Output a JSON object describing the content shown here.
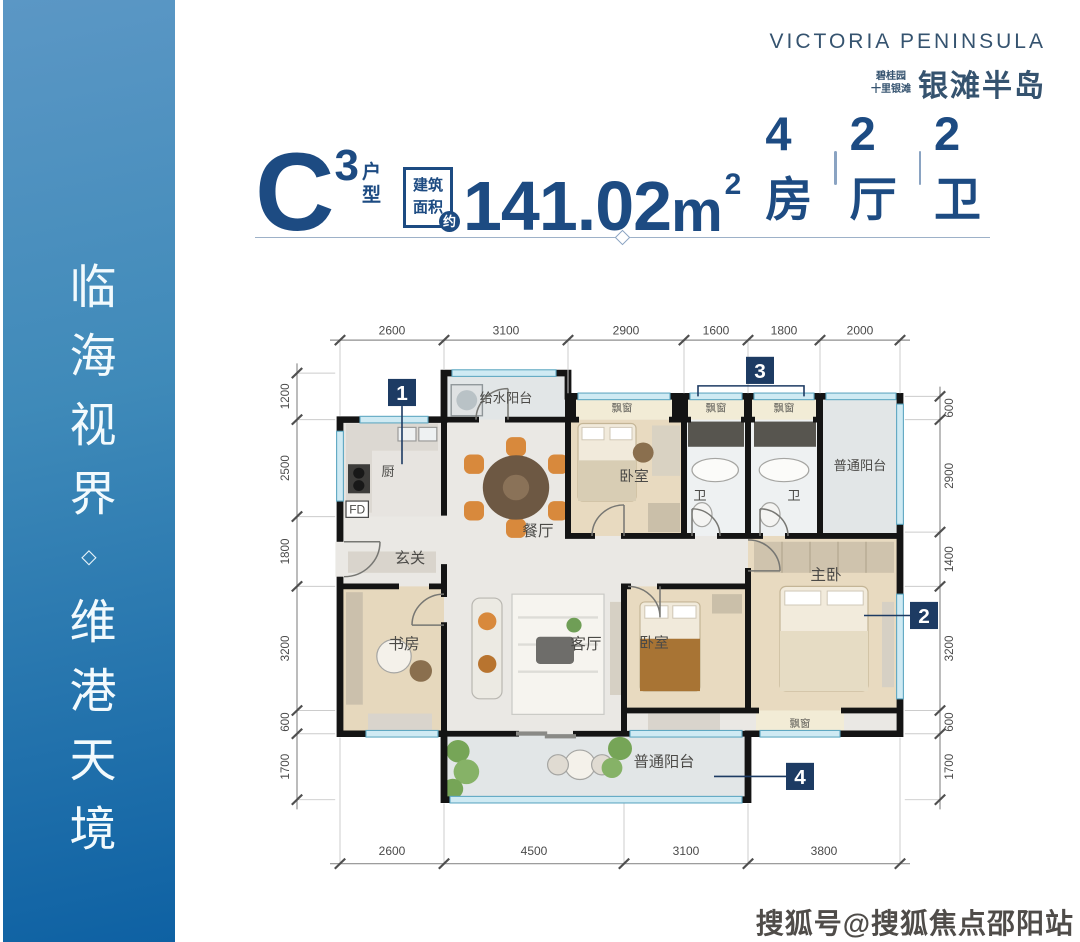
{
  "banner": {
    "line1": "临海视界",
    "diamond": "◇",
    "line2": "维港天境"
  },
  "logo": {
    "en": "VICTORIA PENINSULA",
    "brand_small_1": "碧桂园",
    "brand_small_2": "十里银滩",
    "brand": "银滩半岛"
  },
  "title": {
    "type_letter": "C",
    "type_sup": "3",
    "type_char1": "户",
    "type_char2": "型",
    "area_label_1": "建筑",
    "area_label_2": "面积",
    "area_badge": "约",
    "area_value": "141.02",
    "area_unit": "m",
    "area_unit_sup": "2",
    "spec_rooms": "4房",
    "spec_halls": "2厅",
    "spec_baths": "2卫"
  },
  "plan": {
    "dims": {
      "top": [
        "2600",
        "3100",
        "2900",
        "1600",
        "1800",
        "2000"
      ],
      "bottom": [
        "2600",
        "4500",
        "3100",
        "3800"
      ],
      "left": [
        "1200",
        "2500",
        "1800",
        "3200",
        "600",
        "1700"
      ],
      "right": [
        "600",
        "2900",
        "1400",
        "3200",
        "600",
        "1700"
      ]
    },
    "markers": {
      "m1": "1",
      "m2": "2",
      "m3": "3",
      "m4": "4"
    },
    "labels": {
      "water_balcony": "给水阳台",
      "kitchen": "厨",
      "fd": "FD",
      "foyer": "玄关",
      "dining": "餐厅",
      "bedroom": "卧室",
      "bath": "卫",
      "balcony": "普通阳台",
      "master": "主卧",
      "study": "书房",
      "living": "客厅",
      "bay_window": "飘窗"
    }
  },
  "watermark": {
    "text": "搜狐号@搜狐焦点邵阳站"
  },
  "colors": {
    "accent_navy": "#1d4b82",
    "marker_navy": "#1d3b63",
    "banner_top": "#5b97c5",
    "banner_bottom": "#0e61a3",
    "window_cyan": "#cfeaf3",
    "wall_black": "#141414"
  }
}
